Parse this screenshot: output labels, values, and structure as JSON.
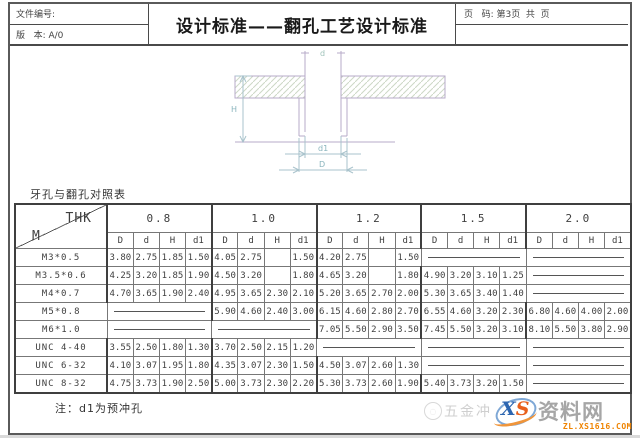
{
  "header": {
    "doc_no_label": "文件编号:",
    "version_label": "版   本: A/0",
    "title": "设计标准——翻孔工艺设计标准",
    "page_label": "页   码: 第3页  共  页"
  },
  "drawing": {
    "dim_top": "d",
    "dim_left": "H",
    "dim_bottom_inner": "d1",
    "dim_bottom_outer": "D"
  },
  "table": {
    "title": "牙孔与翻孔对照表",
    "corner": {
      "top": "THK",
      "bottom": "M"
    },
    "groups": [
      "0.8",
      "1.0",
      "1.2",
      "1.5",
      "2.0"
    ],
    "subheaders": [
      "D",
      "d",
      "H",
      "d1"
    ],
    "rows": [
      {
        "label": "M3*0.5",
        "groups": [
          [
            "3.80",
            "2.75",
            "1.85",
            "1.50"
          ],
          [
            "4.05",
            "2.75",
            "",
            "1.50"
          ],
          [
            "4.20",
            "2.75",
            "",
            "1.50"
          ],
          "dash",
          "dash"
        ]
      },
      {
        "label": "M3.5*0.6",
        "groups": [
          [
            "4.25",
            "3.20",
            "1.85",
            "1.90"
          ],
          [
            "4.50",
            "3.20",
            "",
            "1.80"
          ],
          [
            "4.65",
            "3.20",
            "",
            "1.80"
          ],
          [
            "4.90",
            "3.20",
            "3.10",
            "1.25"
          ],
          "dash"
        ]
      },
      {
        "label": "M4*0.7",
        "groups": [
          [
            "4.70",
            "3.65",
            "1.90",
            "2.40"
          ],
          [
            "4.95",
            "3.65",
            "2.30",
            "2.10"
          ],
          [
            "5.20",
            "3.65",
            "2.70",
            "2.00"
          ],
          [
            "5.30",
            "3.65",
            "3.40",
            "1.40"
          ],
          "dash"
        ]
      },
      {
        "label": "M5*0.8",
        "groups": [
          "dash",
          [
            "5.90",
            "4.60",
            "2.40",
            "3.00"
          ],
          [
            "6.15",
            "4.60",
            "2.80",
            "2.70"
          ],
          [
            "6.55",
            "4.60",
            "3.20",
            "2.30"
          ],
          [
            "6.80",
            "4.60",
            "4.00",
            "2.00"
          ]
        ]
      },
      {
        "label": "M6*1.0",
        "groups": [
          "dash",
          "dash",
          [
            "7.05",
            "5.50",
            "2.90",
            "3.50"
          ],
          [
            "7.45",
            "5.50",
            "3.20",
            "3.10"
          ],
          [
            "8.10",
            "5.50",
            "3.80",
            "2.90"
          ]
        ]
      },
      {
        "label": "UNC 4-40",
        "groups": [
          [
            "3.55",
            "2.50",
            "1.80",
            "1.30"
          ],
          [
            "3.70",
            "2.50",
            "2.15",
            "1.20"
          ],
          "dash",
          "dash",
          "dash"
        ]
      },
      {
        "label": "UNC 6-32",
        "groups": [
          [
            "4.10",
            "3.07",
            "1.95",
            "1.80"
          ],
          [
            "4.35",
            "3.07",
            "2.30",
            "1.50"
          ],
          [
            "4.50",
            "3.07",
            "2.60",
            "1.30"
          ],
          "dash",
          "dash"
        ]
      },
      {
        "label": "UNC 8-32",
        "groups": [
          [
            "4.75",
            "3.73",
            "1.90",
            "2.50"
          ],
          [
            "5.00",
            "3.73",
            "2.30",
            "2.20"
          ],
          [
            "5.30",
            "3.73",
            "2.60",
            "1.90"
          ],
          [
            "5.40",
            "3.73",
            "3.20",
            "1.50"
          ],
          "dash"
        ]
      }
    ]
  },
  "note": "注：d1为预冲孔",
  "watermark": {
    "text_left": "五金冲",
    "logo_x": "X",
    "logo_s": "S",
    "site_name": "资料网",
    "url": "ZL.XS1616.COM"
  }
}
